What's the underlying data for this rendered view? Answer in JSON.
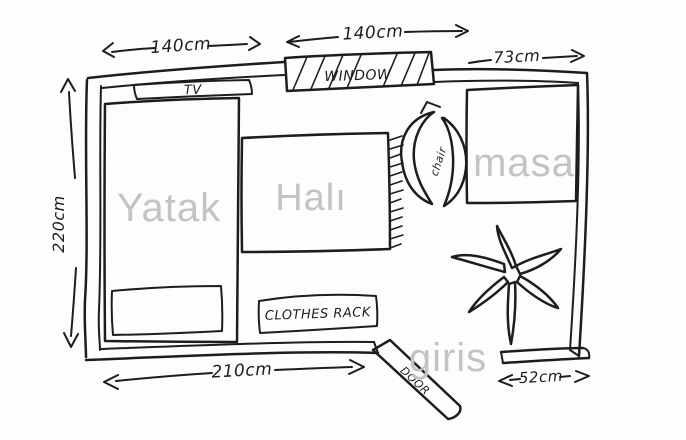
{
  "drawing": {
    "kind": "hand-drawn room floor plan sketch"
  },
  "colors": {
    "ink": "#1f1d1b",
    "label_gray": "#c3c3c3",
    "background": "#fdfdfc"
  },
  "measurements": {
    "wall_top_left": "140cm",
    "window_width": "140cm",
    "wall_top_right": "73cm",
    "wall_left": "220cm",
    "wall_bottom": "210cm",
    "wall_bottom_right": "52cm"
  },
  "labels": {
    "bed": "Yatak",
    "carpet": "Halı",
    "table": "masa",
    "entrance": "giris",
    "tv": "TV",
    "window": "WINDOW",
    "chair": "chair",
    "clothes_rack": "CLOTHES RACK",
    "door": "DOOR"
  }
}
